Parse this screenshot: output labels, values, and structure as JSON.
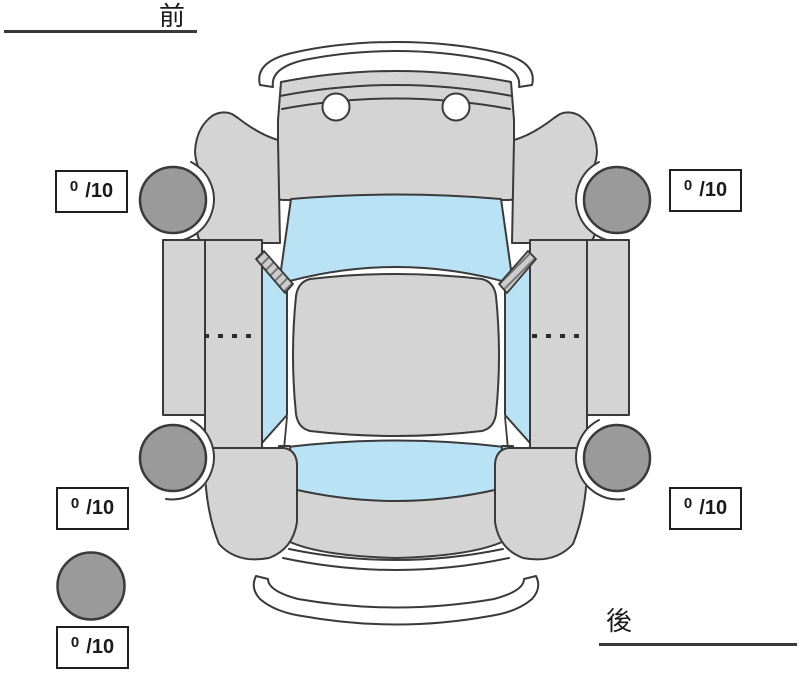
{
  "orientation": {
    "front": "前",
    "rear": "後"
  },
  "tread": {
    "front_left": {
      "value": "0",
      "max": "/10"
    },
    "front_right": {
      "value": "0",
      "max": "/10"
    },
    "rear_left": {
      "value": "0",
      "max": "/10"
    },
    "rear_right": {
      "value": "0",
      "max": "/10"
    },
    "spare": {
      "value": "0",
      "max": "/10"
    }
  },
  "colors": {
    "body": "#d4d4d4",
    "glass": "#b9e2f5",
    "tire": "#9a9a9a",
    "outline": "#3a3a3a",
    "bumper": "#ffffff",
    "text": "#1a1a1a",
    "background": "#ffffff"
  }
}
